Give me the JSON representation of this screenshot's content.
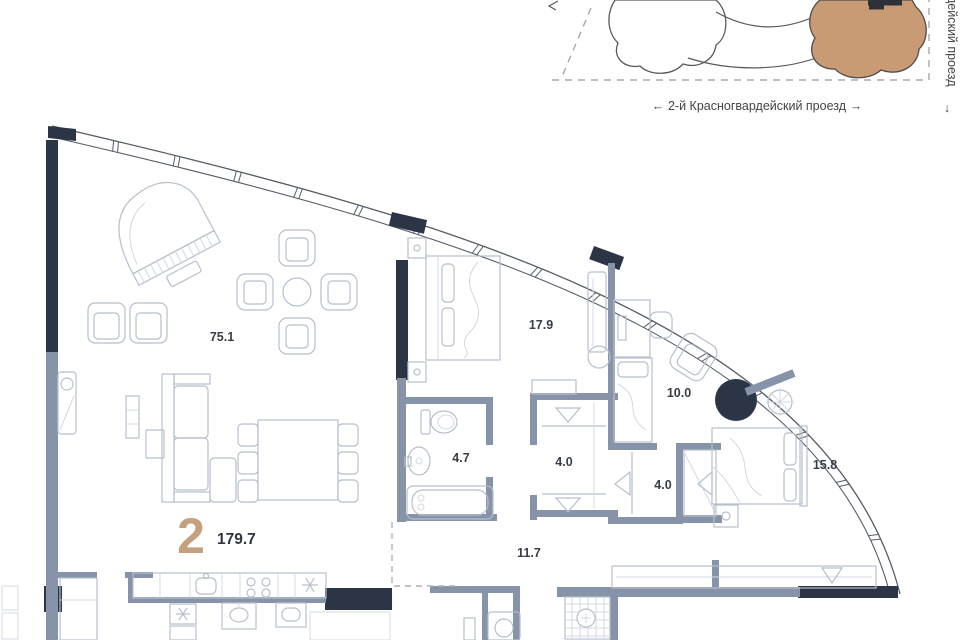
{
  "site_plan": {
    "street_bottom_label": "2-й Красногвардейский проезд",
    "street_right_label": "дейский проезд",
    "arrow_left": "←",
    "arrow_right": "→",
    "arrow_down": "↓"
  },
  "apartment": {
    "number": "2",
    "total_area": "179.7"
  },
  "rooms": {
    "living": {
      "name": "living-kitchen",
      "area": "75.1"
    },
    "bedroom1": {
      "name": "bedroom-1",
      "area": "17.9"
    },
    "cabinet": {
      "name": "cabinet",
      "area": "10.0"
    },
    "bathroom1": {
      "name": "bathroom-1",
      "area": "4.7"
    },
    "wardrobe1": {
      "name": "wardrobe-1",
      "area": "4.0"
    },
    "wardrobe2": {
      "name": "wardrobe-2",
      "area": "4.0"
    },
    "bedroom2": {
      "name": "bedroom-2",
      "area": "15.8"
    },
    "corridor": {
      "name": "corridor",
      "area": "11.7"
    }
  },
  "colors": {
    "wall_dark": "#2b3546",
    "wall_gray": "#8793a8",
    "furniture_line": "#b7bfcc",
    "accent_tan": "#c5a07e",
    "building_tan": "#c89b75",
    "label_dark": "#383d46"
  }
}
